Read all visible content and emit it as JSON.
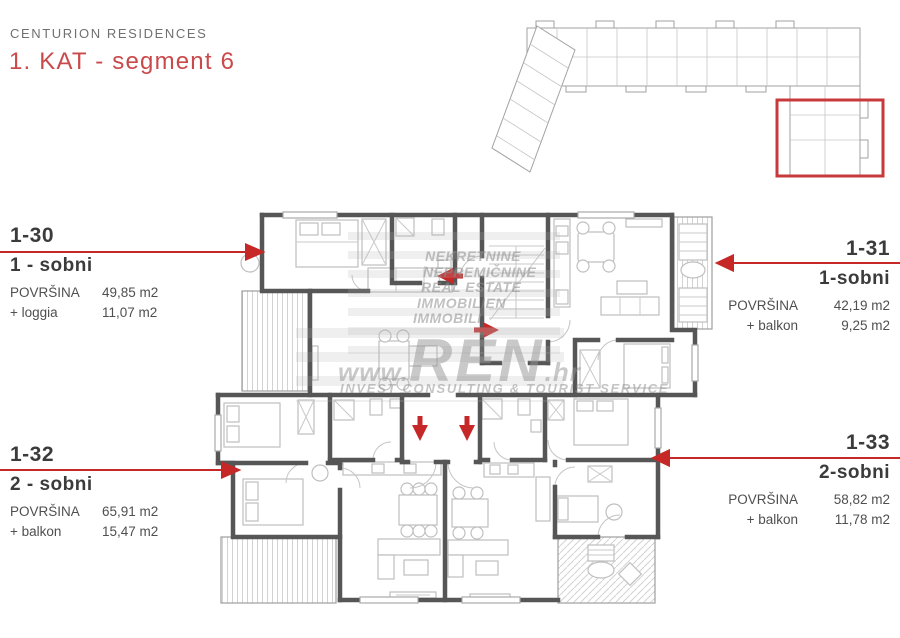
{
  "header": {
    "project": "CENTURION RESIDENCES",
    "title": "1. KAT - segment 6"
  },
  "units": [
    {
      "id": "1-30",
      "type": "1 - sobni",
      "area_label": "POVRŠINA",
      "area": "49,85 m2",
      "extra_label": "+ loggia",
      "extra": "11,07 m2",
      "side": "left"
    },
    {
      "id": "1-31",
      "type": "1-sobni",
      "area_label": "POVRŠINA",
      "area": "42,19 m2",
      "extra_label": "+ balkon",
      "extra": "9,25 m2",
      "side": "right"
    },
    {
      "id": "1-32",
      "type": "2 - sobni",
      "area_label": "POVRŠINA",
      "area": "65,91 m2",
      "extra_label": "+ balkon",
      "extra": "15,47 m2",
      "side": "left"
    },
    {
      "id": "1-33",
      "type": "2-sobni",
      "area_label": "POVRŠINA",
      "area": "58,82 m2",
      "extra_label": "+ balkon",
      "extra": "11,78 m2",
      "side": "right"
    }
  ],
  "watermark": {
    "lines": [
      "NEKRETNINE",
      "NEPREMIČNINE",
      "REAL ESTATE",
      "IMMOBILIEN",
      "IMMOBILI"
    ],
    "brand_prefix": "www.",
    "brand_name": "REN",
    "brand_suffix": ".hr",
    "tagline": "INVEST CONSULTING & TOURIST SERVICE"
  },
  "overview": {
    "highlight_label": "segment 6"
  },
  "colors": {
    "accent_red": "#c62828",
    "title_red": "#c94a4b",
    "heading_gray": "#707070",
    "wall_gray": "#565656",
    "furniture_gray": "#bfbfbf"
  }
}
